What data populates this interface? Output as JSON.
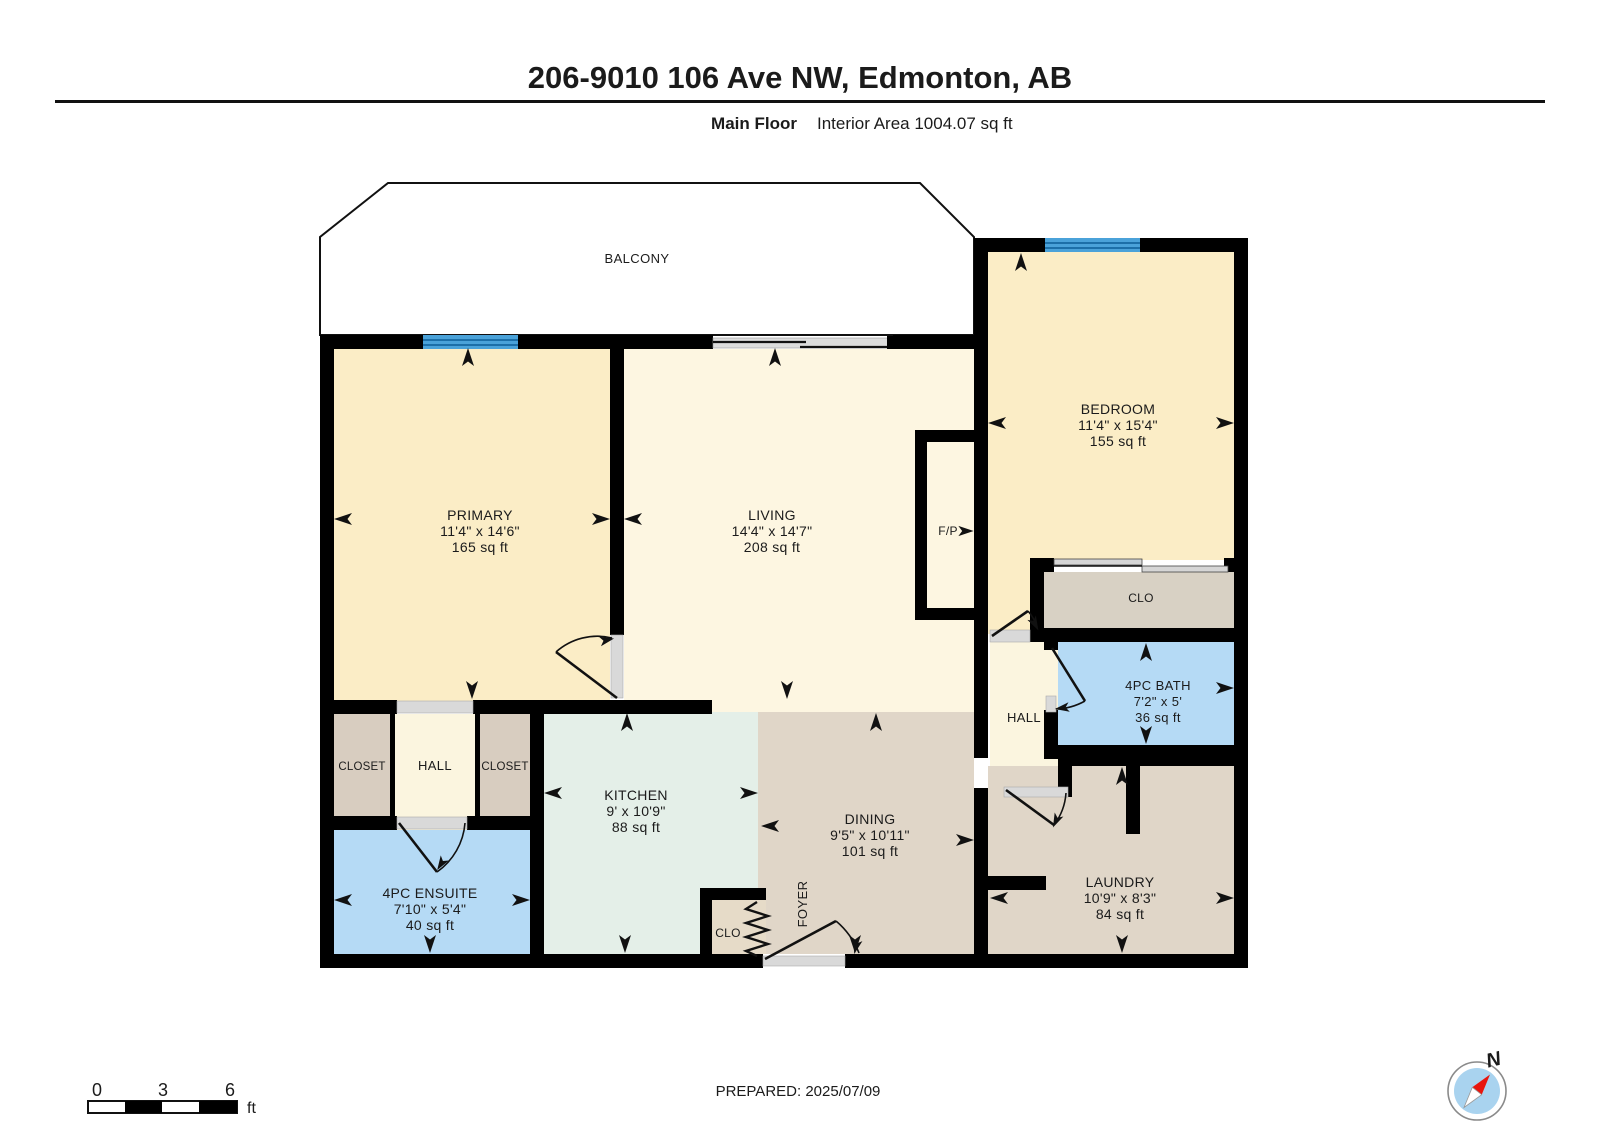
{
  "header": {
    "title": "206-9010 106 Ave NW, Edmonton, AB",
    "floor_label": "Main Floor",
    "area_label": "Interior Area 1004.07 sq ft"
  },
  "rooms": {
    "balcony": {
      "name": "BALCONY"
    },
    "primary": {
      "name": "PRIMARY",
      "dims": "11'4\" x 14'6\"",
      "area": "165 sq ft"
    },
    "living": {
      "name": "LIVING",
      "dims": "14'4\" x 14'7\"",
      "area": "208 sq ft"
    },
    "bedroom": {
      "name": "BEDROOM",
      "dims": "11'4\" x 15'4\"",
      "area": "155 sq ft"
    },
    "fireplace": {
      "name": "F/P"
    },
    "bedroom_closet": {
      "name": "CLO"
    },
    "bath": {
      "name": "4PC BATH",
      "dims": "7'2\" x 5'",
      "area": "36 sq ft"
    },
    "hall_right": {
      "name": "HALL"
    },
    "closet_left": {
      "name": "CLOSET"
    },
    "hall_left": {
      "name": "HALL"
    },
    "closet_right": {
      "name": "CLOSET"
    },
    "kitchen": {
      "name": "KITCHEN",
      "dims": "9' x 10'9\"",
      "area": "88 sq ft"
    },
    "dining": {
      "name": "DINING",
      "dims": "9'5\" x 10'11\"",
      "area": "101 sq ft"
    },
    "foyer": {
      "name": "FOYER"
    },
    "foyer_closet": {
      "name": "CLO"
    },
    "ensuite": {
      "name": "4PC ENSUITE",
      "dims": "7'10\" x 5'4\"",
      "area": "40 sq ft"
    },
    "laundry": {
      "name": "LAUNDRY",
      "dims": "10'9\" x 8'3\"",
      "area": "84 sq ft"
    }
  },
  "scale_bar": {
    "t0": "0",
    "t1": "3",
    "t2": "6",
    "unit": "ft"
  },
  "compass": {
    "north_label": "N"
  },
  "footer": {
    "prepared_label": "PREPARED: 2025/07/09"
  },
  "colors": {
    "wall": "#000000",
    "room_cream": "#fbedc6",
    "room_cream_light": "#fdf6e1",
    "hall_cream": "#fbf5df",
    "closet_tan": "#d8cdc0",
    "clo_gray": "#d8d1c4",
    "kitchen_mint": "#e4efe8",
    "dining_tan": "#e0d6c8",
    "bath_blue": "#b5daf5",
    "window_blue": "#4aa2d9",
    "compass_blue": "#a9d3ef",
    "compass_red": "#e8150d"
  }
}
